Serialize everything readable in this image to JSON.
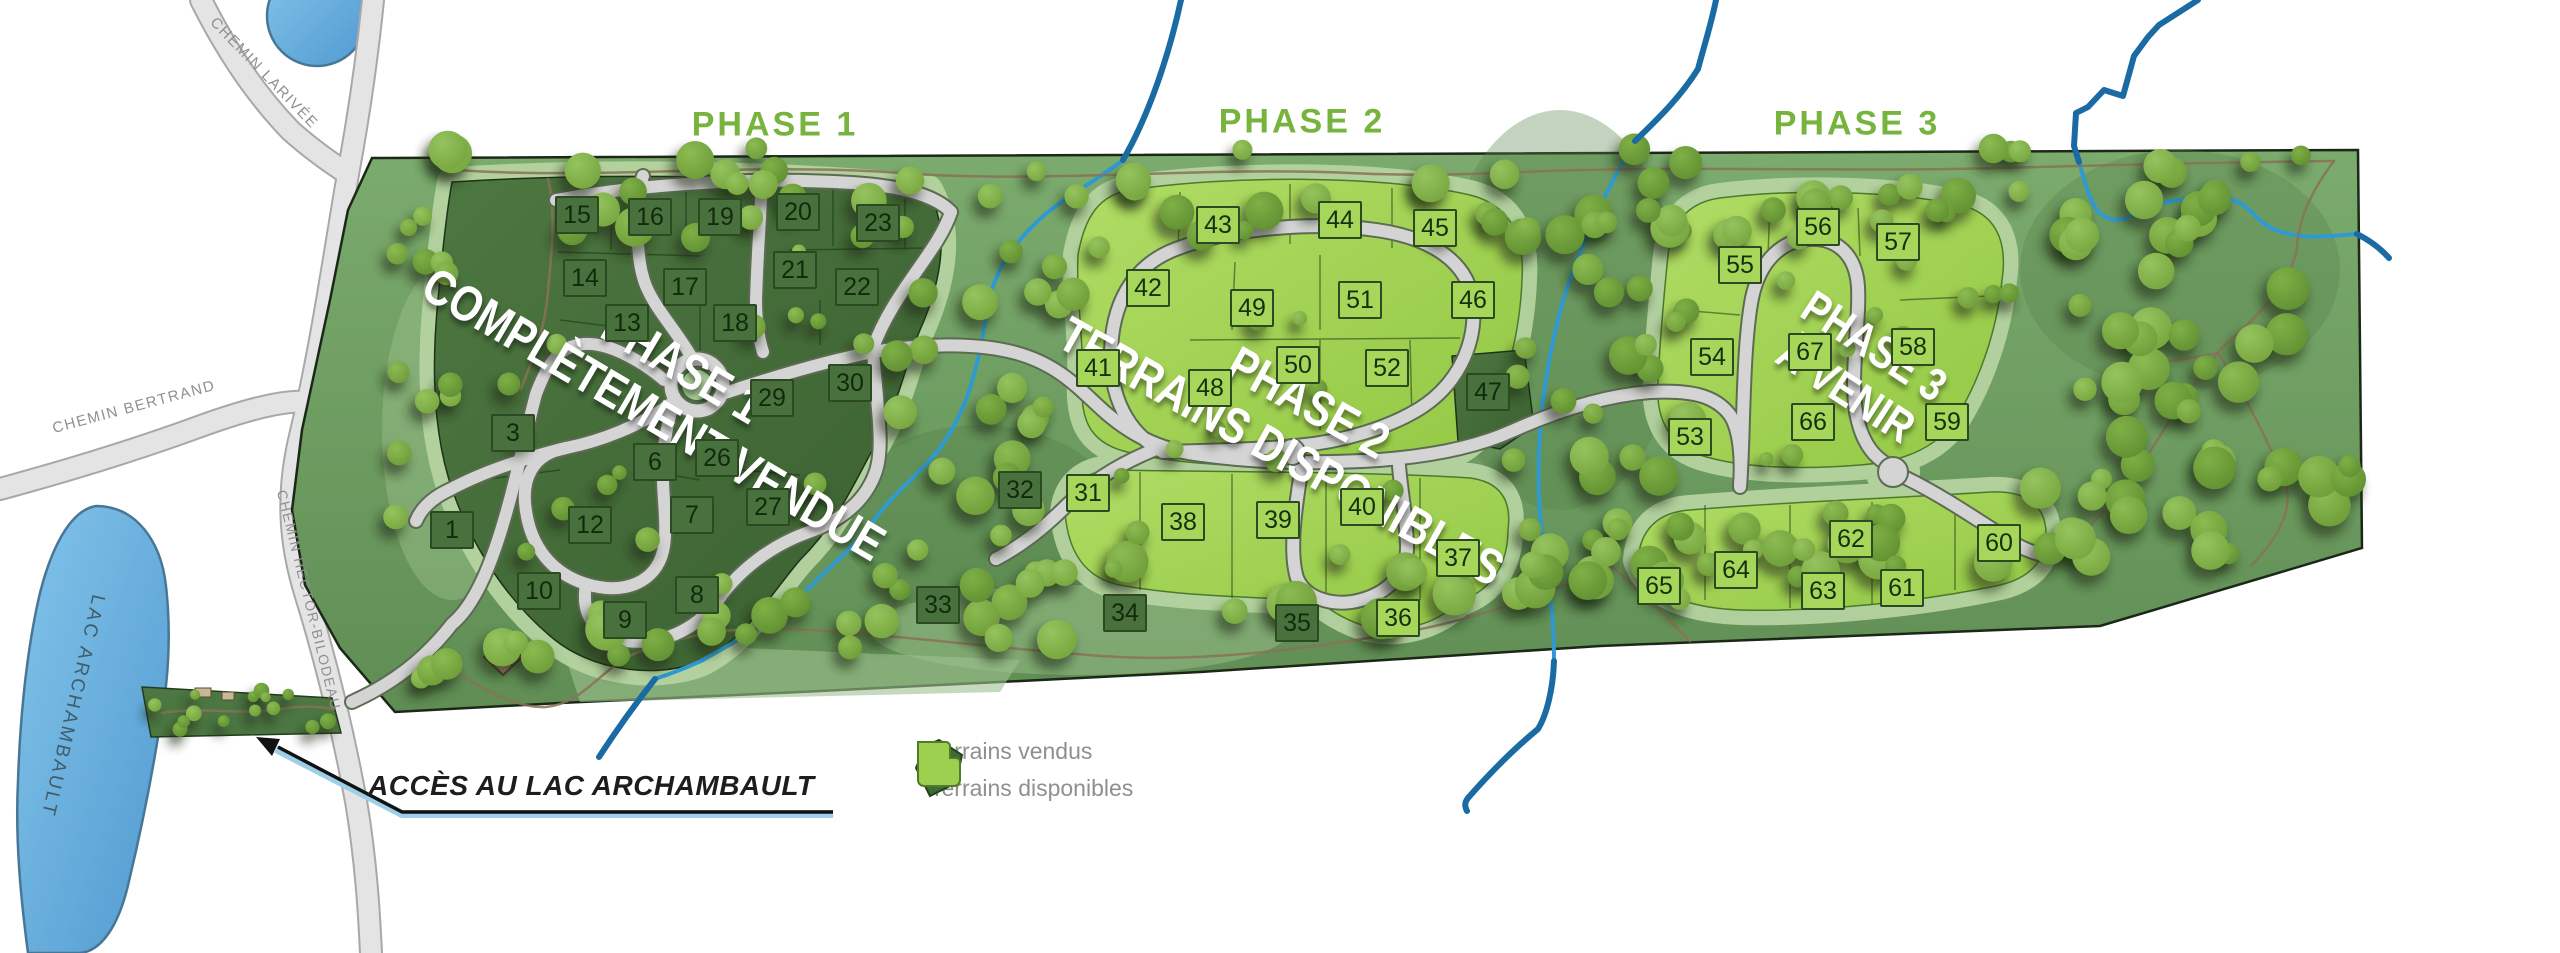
{
  "phases": [
    {
      "header": "PHASE 1",
      "overlay1": "PHASE 1",
      "overlay2": "COMPLÈTEMENT VENDUE"
    },
    {
      "header": "PHASE 2",
      "overlay1": "PHASE 2",
      "overlay2": "TERRAINS DISPONIBLES"
    },
    {
      "header": "PHASE 3",
      "overlay1": "PHASE 3",
      "overlay2": "À VENIR"
    }
  ],
  "road_labels": {
    "larivee": "CHEMIN LARIVÉE",
    "bertrand": "CHEMIN BERTRAND",
    "hector_bilodeau": "CHEMIN HECTOR-BILODEAU"
  },
  "lake_label": "LAC ARCHAMBAULT",
  "access_label": "ACCÈS AU LAC ARCHAMBAULT",
  "legend": {
    "sold": "Terrains vendus",
    "available": "Terrains disponibles"
  },
  "colors": {
    "phase_header_green": "#76b43e",
    "sold_lot_green": "#49713d",
    "available_lot_green": "#a6d75a",
    "sage_verge": "#b5d3a0",
    "forest_green": "#6f9d63",
    "road_gray": "#d4d4d4",
    "stream_blue": "#2f9ad2",
    "outer_stream_blue": "#1a6aa3",
    "lake_blue": "#79bde6",
    "trail_brown": "#8a7258",
    "legend_text_gray": "#8f8f8f",
    "overlay_text": "#ffffff"
  },
  "lots": [
    {
      "n": 1,
      "x": 452,
      "y": 530,
      "status": "sold"
    },
    {
      "n": 3,
      "x": 513,
      "y": 433,
      "status": "sold"
    },
    {
      "n": 6,
      "x": 655,
      "y": 462,
      "status": "sold"
    },
    {
      "n": 7,
      "x": 692,
      "y": 515,
      "status": "sold"
    },
    {
      "n": 8,
      "x": 697,
      "y": 595,
      "status": "sold"
    },
    {
      "n": 9,
      "x": 625,
      "y": 620,
      "status": "sold"
    },
    {
      "n": 10,
      "x": 539,
      "y": 591,
      "status": "sold"
    },
    {
      "n": 12,
      "x": 590,
      "y": 525,
      "status": "sold"
    },
    {
      "n": 13,
      "x": 627,
      "y": 323,
      "status": "sold"
    },
    {
      "n": 14,
      "x": 585,
      "y": 278,
      "status": "sold"
    },
    {
      "n": 15,
      "x": 577,
      "y": 215,
      "status": "sold"
    },
    {
      "n": 16,
      "x": 650,
      "y": 217,
      "status": "sold"
    },
    {
      "n": 17,
      "x": 685,
      "y": 287,
      "status": "sold"
    },
    {
      "n": 18,
      "x": 735,
      "y": 323,
      "status": "sold"
    },
    {
      "n": 19,
      "x": 720,
      "y": 217,
      "status": "sold"
    },
    {
      "n": 20,
      "x": 798,
      "y": 212,
      "status": "sold"
    },
    {
      "n": 21,
      "x": 795,
      "y": 270,
      "status": "sold"
    },
    {
      "n": 22,
      "x": 857,
      "y": 287,
      "status": "sold"
    },
    {
      "n": 23,
      "x": 878,
      "y": 223,
      "status": "sold"
    },
    {
      "n": 26,
      "x": 717,
      "y": 458,
      "status": "sold"
    },
    {
      "n": 27,
      "x": 768,
      "y": 507,
      "status": "sold"
    },
    {
      "n": 29,
      "x": 772,
      "y": 398,
      "status": "sold"
    },
    {
      "n": 30,
      "x": 850,
      "y": 383,
      "status": "sold"
    },
    {
      "n": 31,
      "x": 1088,
      "y": 493,
      "status": "available"
    },
    {
      "n": 32,
      "x": 1020,
      "y": 490,
      "status": "sold"
    },
    {
      "n": 33,
      "x": 938,
      "y": 605,
      "status": "sold"
    },
    {
      "n": 34,
      "x": 1125,
      "y": 613,
      "status": "sold"
    },
    {
      "n": 35,
      "x": 1297,
      "y": 623,
      "status": "sold"
    },
    {
      "n": 36,
      "x": 1398,
      "y": 618,
      "status": "available"
    },
    {
      "n": 37,
      "x": 1458,
      "y": 558,
      "status": "available"
    },
    {
      "n": 38,
      "x": 1183,
      "y": 522,
      "status": "available"
    },
    {
      "n": 39,
      "x": 1278,
      "y": 520,
      "status": "available"
    },
    {
      "n": 40,
      "x": 1362,
      "y": 507,
      "status": "available"
    },
    {
      "n": 41,
      "x": 1098,
      "y": 368,
      "status": "available"
    },
    {
      "n": 42,
      "x": 1148,
      "y": 288,
      "status": "available"
    },
    {
      "n": 43,
      "x": 1218,
      "y": 225,
      "status": "available"
    },
    {
      "n": 44,
      "x": 1340,
      "y": 220,
      "status": "available"
    },
    {
      "n": 45,
      "x": 1435,
      "y": 228,
      "status": "available"
    },
    {
      "n": 46,
      "x": 1473,
      "y": 300,
      "status": "available"
    },
    {
      "n": 47,
      "x": 1488,
      "y": 392,
      "status": "sold"
    },
    {
      "n": 48,
      "x": 1210,
      "y": 388,
      "status": "available"
    },
    {
      "n": 49,
      "x": 1252,
      "y": 308,
      "status": "available"
    },
    {
      "n": 50,
      "x": 1298,
      "y": 365,
      "status": "available"
    },
    {
      "n": 51,
      "x": 1360,
      "y": 300,
      "status": "available"
    },
    {
      "n": 52,
      "x": 1387,
      "y": 368,
      "status": "available"
    },
    {
      "n": 53,
      "x": 1690,
      "y": 437,
      "status": "available"
    },
    {
      "n": 54,
      "x": 1712,
      "y": 357,
      "status": "available"
    },
    {
      "n": 55,
      "x": 1740,
      "y": 265,
      "status": "available"
    },
    {
      "n": 56,
      "x": 1818,
      "y": 227,
      "status": "available"
    },
    {
      "n": 57,
      "x": 1898,
      "y": 242,
      "status": "available"
    },
    {
      "n": 58,
      "x": 1913,
      "y": 347,
      "status": "available"
    },
    {
      "n": 59,
      "x": 1947,
      "y": 422,
      "status": "available"
    },
    {
      "n": 60,
      "x": 1999,
      "y": 543,
      "status": "available"
    },
    {
      "n": 61,
      "x": 1902,
      "y": 588,
      "status": "available"
    },
    {
      "n": 62,
      "x": 1851,
      "y": 539,
      "status": "available"
    },
    {
      "n": 63,
      "x": 1823,
      "y": 591,
      "status": "available"
    },
    {
      "n": 64,
      "x": 1736,
      "y": 570,
      "status": "available"
    },
    {
      "n": 65,
      "x": 1659,
      "y": 586,
      "status": "available"
    },
    {
      "n": 66,
      "x": 1813,
      "y": 422,
      "status": "available"
    },
    {
      "n": 67,
      "x": 1810,
      "y": 352,
      "status": "available"
    }
  ]
}
